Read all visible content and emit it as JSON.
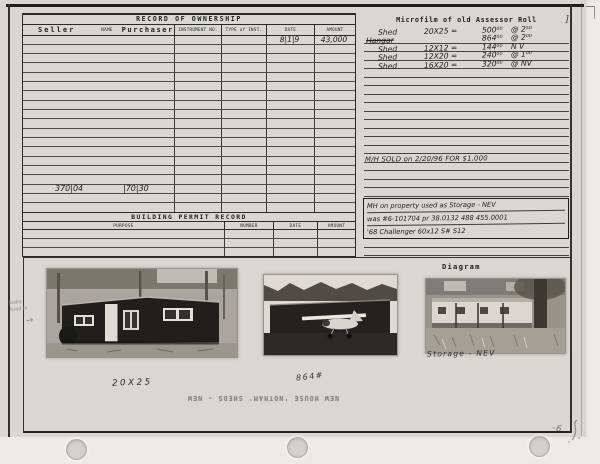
{
  "ownership": {
    "title": "RECORD OF OWNERSHIP",
    "columns": {
      "seller": "Seller",
      "name_label": "NAME",
      "purchaser": "Purchaser",
      "instrument": "INSTRUMENT NO.",
      "type": "TYPE of INST.",
      "date": "DATE",
      "amount": "AMOUNT"
    },
    "row_count": 19,
    "entries": [
      {
        "row": 0,
        "date": "8|1|9",
        "amount": "43,000"
      },
      {
        "row": 16,
        "left_value": "370|04",
        "right_value": "|70|30"
      }
    ]
  },
  "permit": {
    "title": "BUILDING PERMIT RECORD",
    "columns": [
      "PURPOSE",
      "NUMBER",
      "DATE",
      "AMOUNT"
    ],
    "row_count": 3
  },
  "microfilm": {
    "title": "Microfilm of old Assessor Roll",
    "title_mark": "]",
    "line_count": 26,
    "entries": [
      {
        "item": "Shed",
        "size": "20X25 =",
        "value": "500⁰⁰",
        "rate": "@ 2⁵⁰",
        "struck": false
      },
      {
        "item": "Hangar",
        "size": "",
        "value": "864⁰⁰",
        "rate": "@ 2⁰⁰",
        "struck": true
      },
      {
        "item": "Shed",
        "size": "12X12 =",
        "value": "144⁰⁰",
        "rate": "N V",
        "struck": false
      },
      {
        "item": "Shed",
        "size": "12X20 =",
        "value": "240⁰⁰",
        "rate": "@ 1⁰⁰",
        "struck": false
      },
      {
        "item": "Shed",
        "size": "16X20 =",
        "value": "320⁰⁰",
        "rate": "@ NV",
        "struck": false
      }
    ],
    "sold_note": "M/H SOLD on 2/20/96 FOR $1,000",
    "note_lines": [
      "MH on property used as Storage - NEV",
      "was #6-101704 pr 38.0132 488 455.0001",
      "'68 Challenger 60x12 S# S12"
    ]
  },
  "photos": {
    "diagram_title": "Diagram",
    "label_cabin": "20X25",
    "label_hangar": "864#",
    "label_trailer": "Storage - NEV",
    "margin_note_line1": "looks",
    "margin_note_line2": "lived in",
    "margin_arrow": "→"
  },
  "marginalia": {
    "bleedthrough": "NEW HOUSE 'NOTHAM' SHEDS - NEW",
    "corner_mark": "-6"
  }
}
